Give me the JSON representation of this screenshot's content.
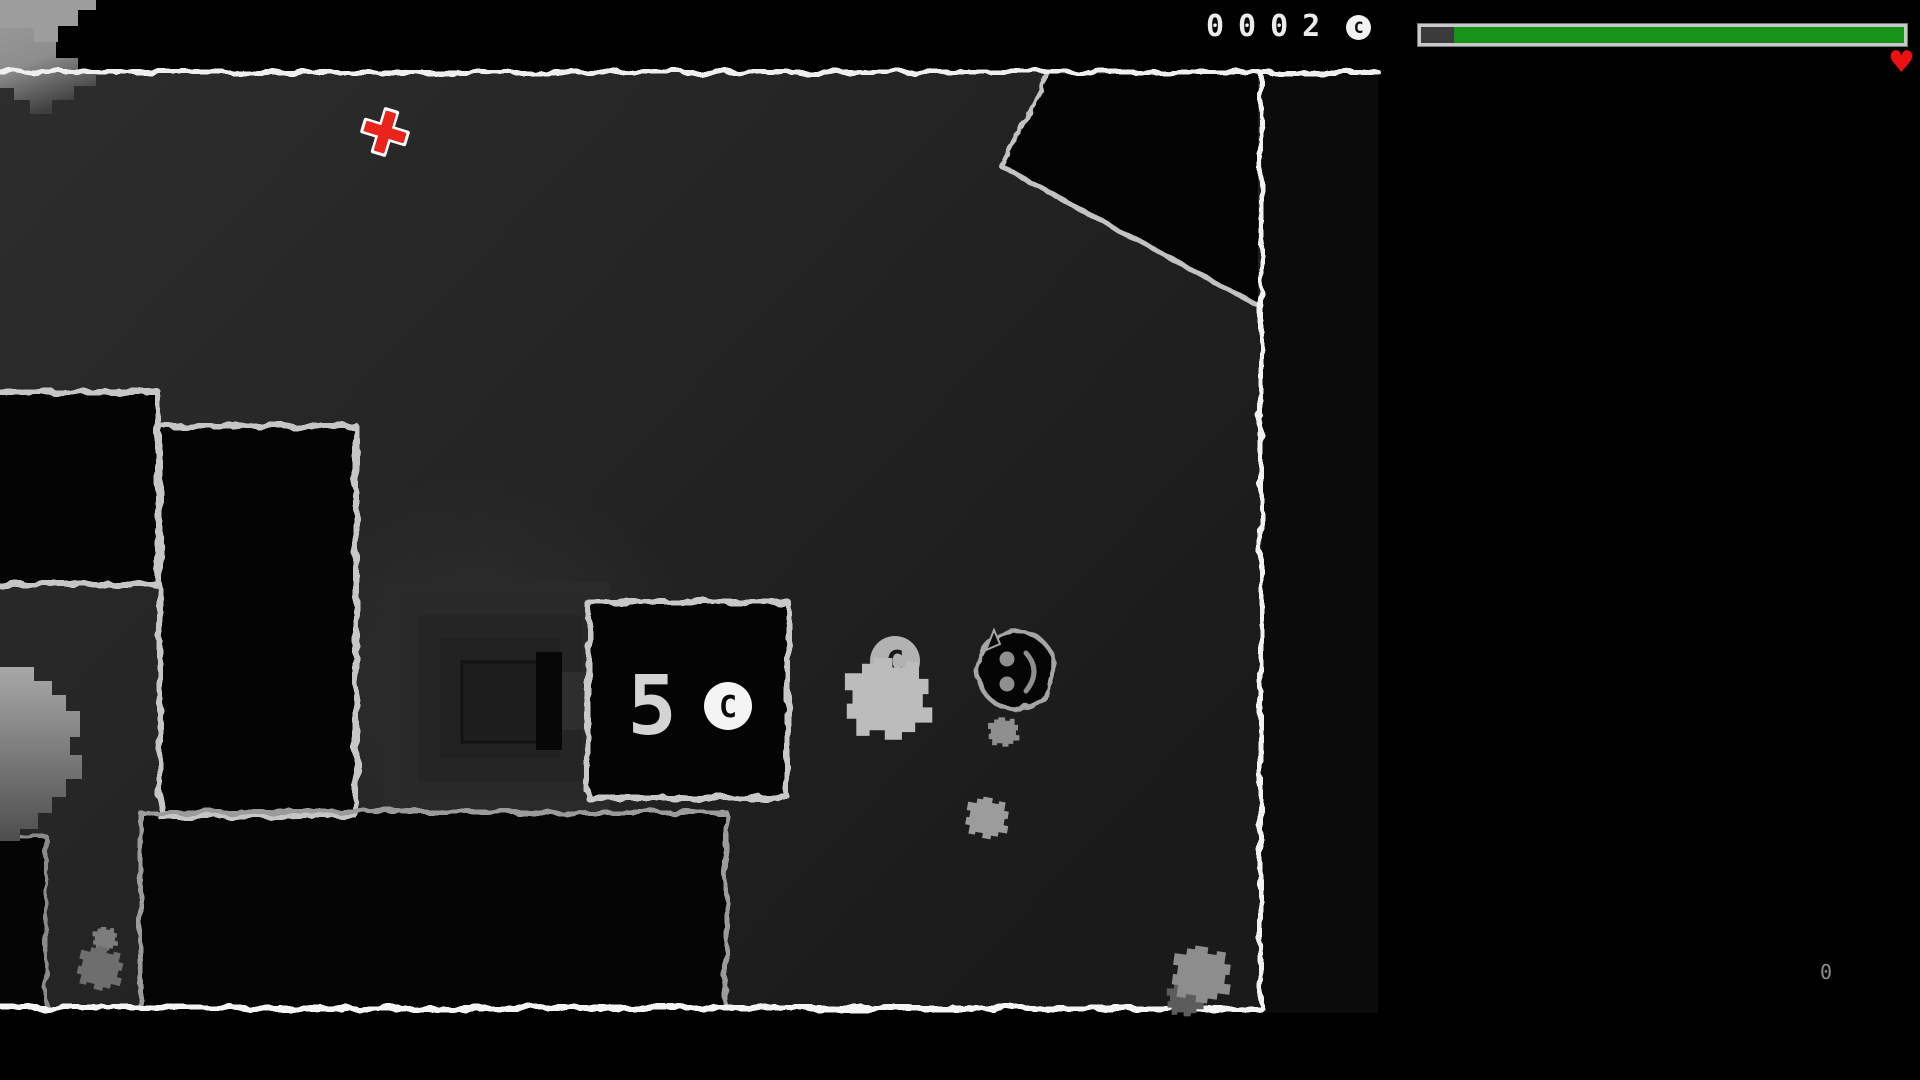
{
  "hud": {
    "coin_counter": {
      "digits": "0002",
      "coin_symbol": "C"
    },
    "progress_bar": {
      "fill_style": "width:93.2%",
      "fill_color": "#169417",
      "track_color": "#3b3b3b",
      "border_color": "#c9c9c9"
    },
    "heart_icon": "♥",
    "heart_color": "#ee1111",
    "score_small": "0"
  },
  "sign": {
    "price": "5",
    "coin_symbol": "C"
  },
  "field": {
    "coin_symbol": "C"
  },
  "colors": {
    "cursor_red": "#e8241b",
    "boundary_white": "#f0f0f0",
    "structure_border_gray": "#c6c6c6",
    "platform_border_gray": "#9b9b9b",
    "blob_gray": "#bcbcbc",
    "play_background": "#242424",
    "outer_band": "#0b0b0b"
  }
}
